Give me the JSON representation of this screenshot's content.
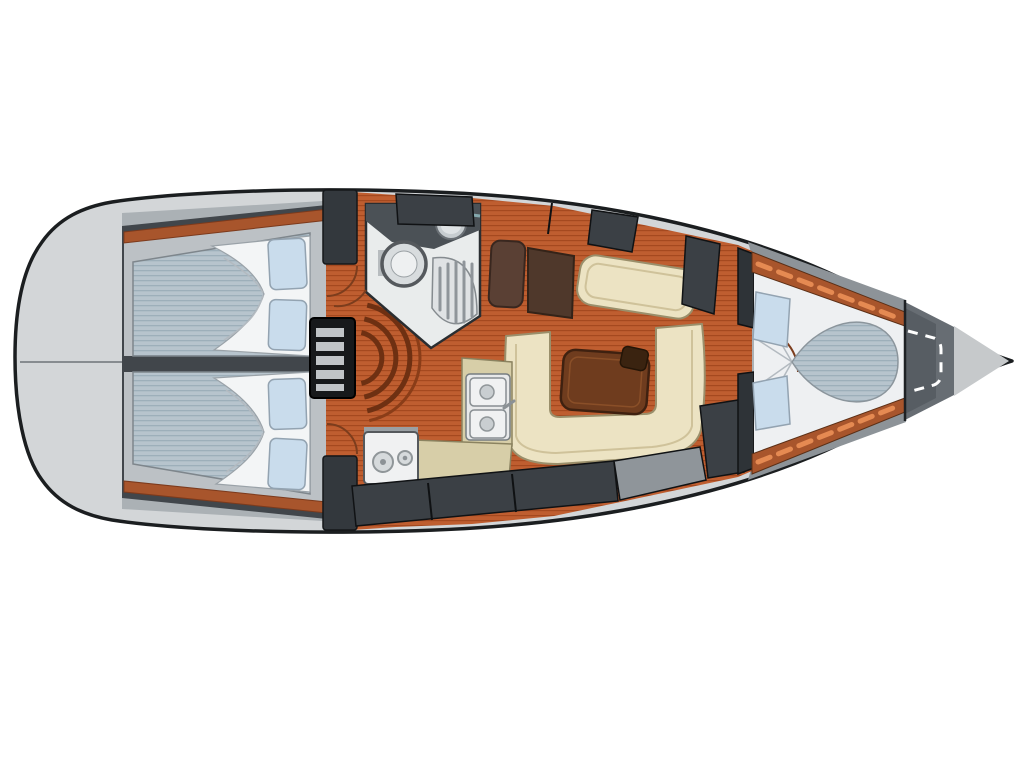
{
  "diagram": {
    "type": "sailboat-interior-floor-plan",
    "orientation": "bow-right",
    "regions": [
      "transom-deck",
      "aft-cabin-port",
      "aft-cabin-starboard",
      "companionway-steps",
      "head-compartment",
      "galley",
      "salon",
      "v-berth-cabin",
      "anchor-locker",
      "bow-tip"
    ]
  },
  "palette": {
    "background": "#ffffff",
    "hull_fill": "#d3d6d8",
    "hull_outline": "#1b1e20",
    "deck_band": "#abb1b5",
    "bow_band": "#8d9398",
    "locker_dark": "#3b4045",
    "locker_mid": "#8f959a",
    "wall_dark": "#41464b",
    "bulkhead": "#2e3337",
    "wood_floor": "#bf5e30",
    "wood_floor_stripe": "#a5491f",
    "wood_trim": "#a8552c",
    "trim_dash": "#e58a52",
    "shelf_gray": "#bcc1c5",
    "mattress": "#b7c4cd",
    "mattress_stripe": "#9dafba",
    "pillow": "#c9dcec",
    "linen": "#f3f5f6",
    "settee": "#ece3c3",
    "settee_line": "#cfc29a",
    "settee_edge": "#9a8f6b",
    "table": "#6f3c1e",
    "table_knob": "#3a2310",
    "counter": "#d7cea8",
    "appliance": "#f0f1f2",
    "burner": "#d6dadc",
    "head_floor": "#e9ecec",
    "fixture_dark": "#4b5156",
    "fixture_mid": "#c7cdd0",
    "toilet_ring": "#d8dcde",
    "grate": "#8f959a",
    "steps_black": "#17191b",
    "step_tread": "#c0c4c7",
    "arc_brown": "#6e3012",
    "maroon_a": "#5a4034",
    "maroon_b": "#4f382b",
    "anchor_locker": "#676d73",
    "anchor_inner": "#575d63",
    "bow_tip": "#c6c9cb",
    "transom_line": "#878c90",
    "sheet_fold": "#b3bac0",
    "door_arc": "#7c3d1d"
  }
}
